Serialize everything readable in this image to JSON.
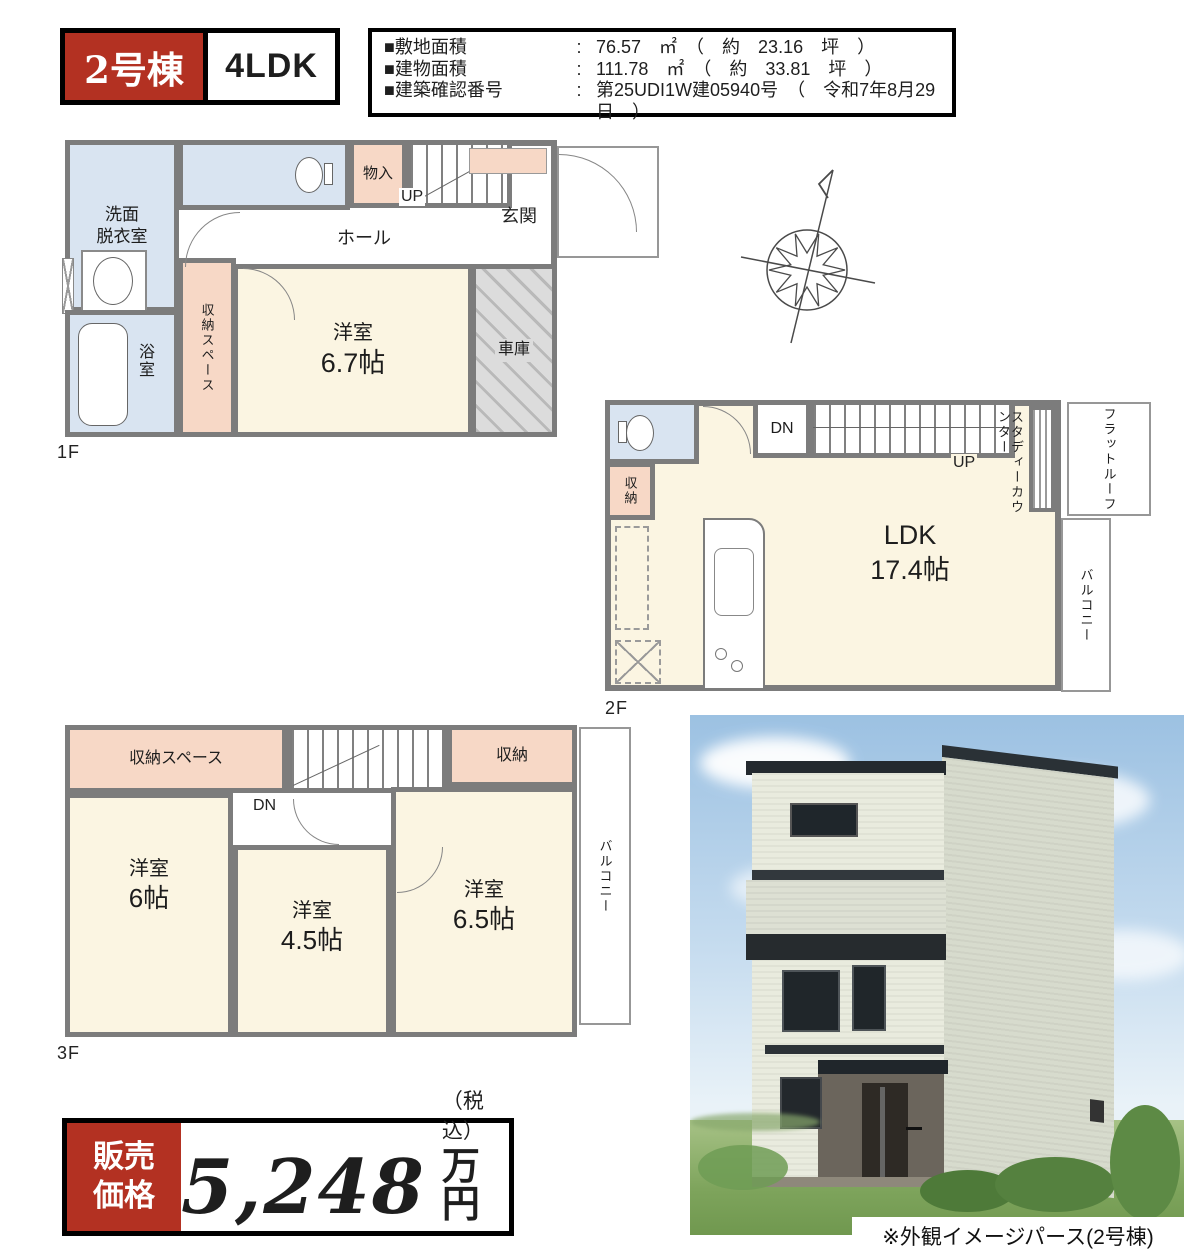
{
  "header": {
    "unit_badge": "2号棟",
    "layout": "4LDK",
    "specs": [
      {
        "label": "■敷地面積",
        "colon": ":",
        "value": "76.57　㎡　（　約　23.16　坪　）"
      },
      {
        "label": "■建物面積",
        "colon": ":",
        "value": "111.78　㎡　（　約　33.81　坪　）"
      },
      {
        "label": "■建築確認番号",
        "colon": ":",
        "value": "第25UDI1W建05940号　（　令和7年8月29日　）"
      }
    ]
  },
  "floor1": {
    "floor_label": "1F",
    "washroom_line1": "洗面",
    "washroom_line2": "脱衣室",
    "mono_ire": "物入",
    "up": "UP",
    "hall": "ホール",
    "genkan": "玄関",
    "storage_space": "収納スペース",
    "room_name": "洋室",
    "room_size": "6.7帖",
    "bath": "浴室",
    "garage": "車庫"
  },
  "floor2": {
    "floor_label": "2F",
    "dn": "DN",
    "up": "UP",
    "storage": "収納",
    "ldk_name": "LDK",
    "ldk_size": "17.4帖",
    "study_counter": "スタディーカウンター",
    "flat_roof": "フラットルーフ",
    "balcony": "バルコニー"
  },
  "floor3": {
    "floor_label": "3F",
    "storage_space": "収納スペース",
    "dn": "DN",
    "storage": "収納",
    "room1_name": "洋室",
    "room1_size": "6帖",
    "room2_name": "洋室",
    "room2_size": "4.5帖",
    "room3_name": "洋室",
    "room3_size": "6.5帖",
    "balcony": "バルコニー"
  },
  "price": {
    "label_line1": "販売",
    "label_line2": "価格",
    "amount": "5,248",
    "tax_note": "（税込）",
    "unit": "万円"
  },
  "rendering": {
    "caption": "※外観イメージパース(2号棟)"
  },
  "colors": {
    "accent_red": "#b33122",
    "wall": "#7c7c7c",
    "cream": "#fbf5e2",
    "blue": "#d9e4f1",
    "pink": "#f7d8c6",
    "garage": "#dcdcdc"
  }
}
